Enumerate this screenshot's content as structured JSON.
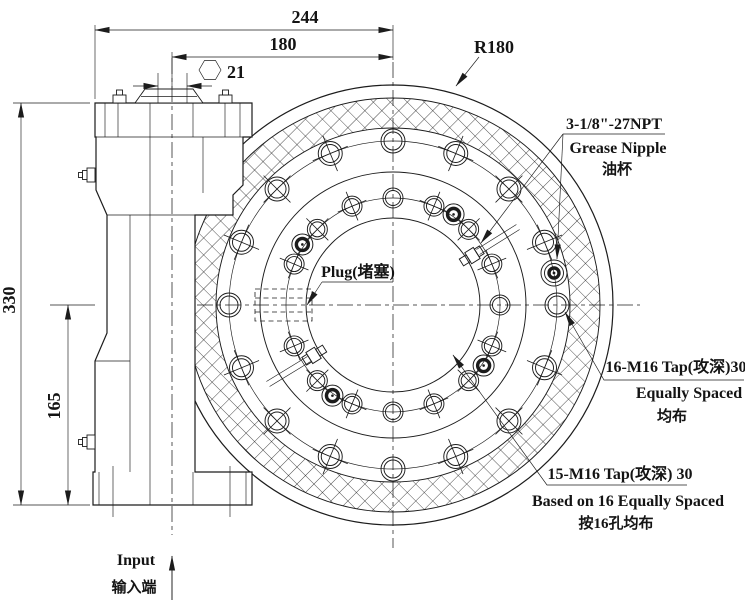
{
  "drawing": {
    "title": "slewing-drive-technical-drawing",
    "dimensions": {
      "width_overall": "244",
      "width_input": "180",
      "hex_size": "21",
      "height_overall": "330",
      "height_lower": "165",
      "outer_radius": "R180"
    },
    "labels": {
      "grease_spec": "3-1/8\"-27NPT",
      "grease_en": "Grease Nipple",
      "grease_cn": "油杯",
      "plug": "Plug(堵塞)",
      "outer_tap_line1": "16-M16 Tap(攻深)30",
      "outer_tap_line2": "Equally Spaced",
      "outer_tap_line3": "均布",
      "inner_tap_line1": "15-M16 Tap(攻深) 30",
      "inner_tap_line2": "Based on 16 Equally Spaced",
      "inner_tap_line3": "按16孔均布",
      "input_en": "Input",
      "input_cn": "输入端"
    },
    "front_view": {
      "center": [
        393,
        305
      ],
      "radii": {
        "outer": 220,
        "gear_outer": 207,
        "gear_inner": 177,
        "outer_bolt": 164,
        "flange_inner": 133,
        "inner_bolt": 107,
        "bore": 87
      },
      "outer_holes": {
        "count": 16,
        "r_outer": 12,
        "r_inner": 9
      },
      "inner_holes": {
        "count": 16,
        "skip_angle": 270,
        "r_outer": 10,
        "r_inner": 7.5
      },
      "ring_symbols": {
        "angles": [
          33.75,
          123.75,
          213.75,
          303.75
        ],
        "radius": 109
      },
      "grease_nipple_angle": 78.75
    },
    "colors": {
      "line": "#1c1c1c",
      "background": "#ffffff"
    }
  }
}
